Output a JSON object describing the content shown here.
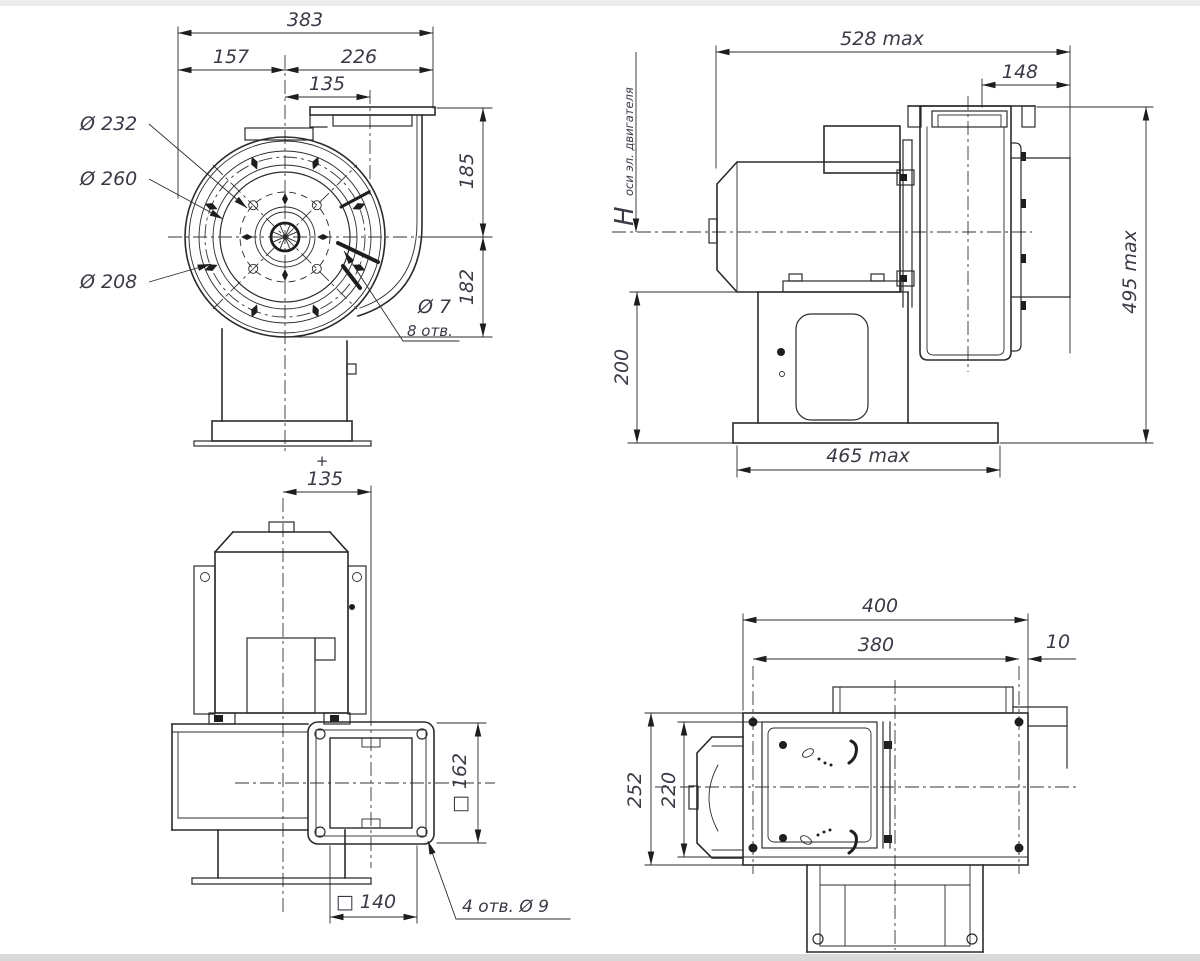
{
  "meta": {
    "type": "technical-drawing",
    "subject": "centrifugal fan dimensional drawing, four orthographic views",
    "colors": {
      "background": "#ffffff",
      "line": "#2b2b2e",
      "text": "#3a3a46"
    }
  },
  "front_view": {
    "dim_383": "383",
    "dim_157": "157",
    "dim_226": "226",
    "dim_135": "135",
    "dim_185": "185",
    "dim_182": "182",
    "label_d232": "Ø 232",
    "label_d260": "Ø 260",
    "label_d208": "Ø 208",
    "label_d7": "Ø 7",
    "label_8_holes": "8 отв.",
    "plus_mark": "+"
  },
  "side_view": {
    "dim_528": "528 max",
    "dim_148": "148",
    "h_main": "H",
    "h_sub": "оси эл. двигателя",
    "dim_200": "200",
    "dim_465": "465 max",
    "dim_495": "495 max"
  },
  "top_view": {
    "dim_135": "135",
    "dim_162": "□ 162",
    "dim_140": "□ 140",
    "label_4_holes": "4 отв.  Ø 9"
  },
  "bottom_view": {
    "dim_400": "400",
    "dim_380": "380",
    "dim_10": "10",
    "dim_252": "252",
    "dim_220": "220"
  }
}
